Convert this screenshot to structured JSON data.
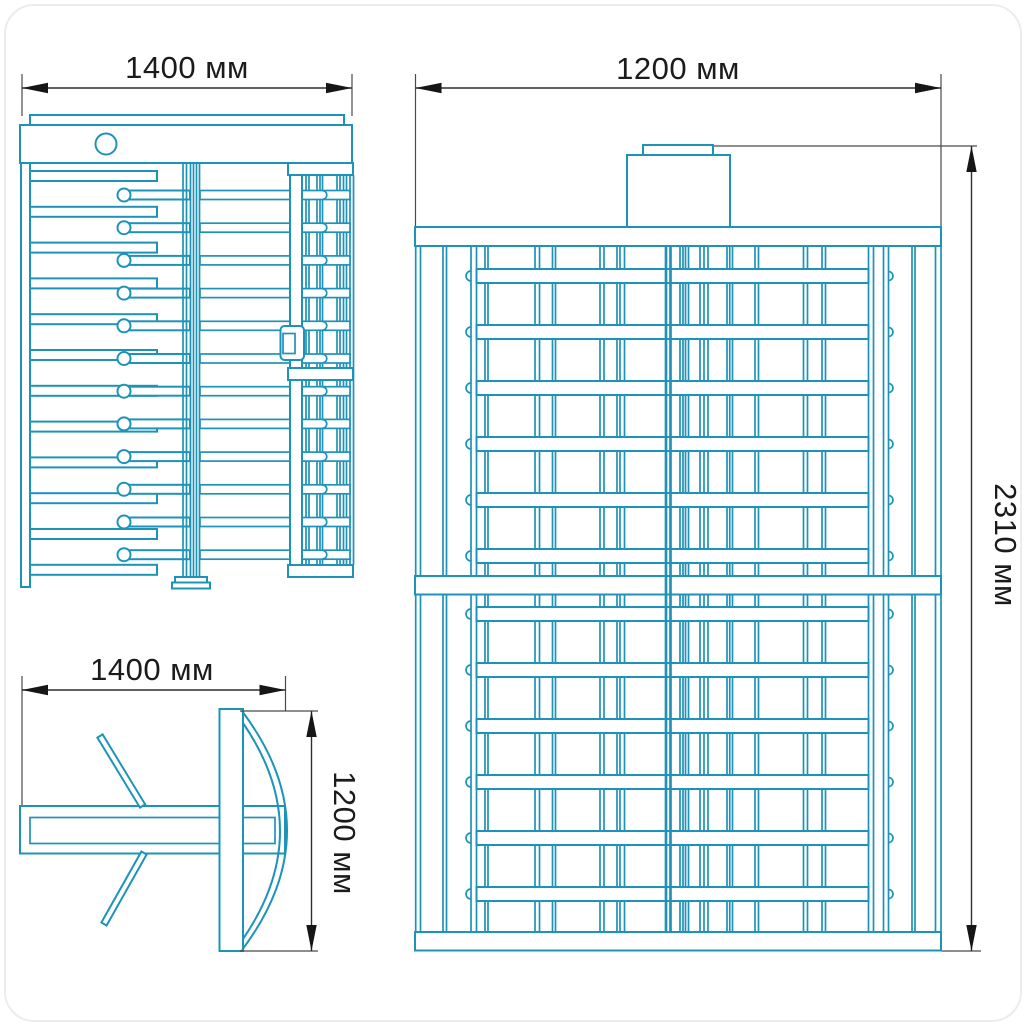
{
  "drawing": {
    "title": "full-height-turnstile-dimension-drawing",
    "line_color": "#1e93b8",
    "dim_text_color": "#1b1b1b",
    "arrow_color": "#161616",
    "views": {
      "side": {
        "width_label": "1400 мм"
      },
      "front": {
        "width_label": "1200 мм",
        "height_label": "2310 мм"
      },
      "plan": {
        "width_label": "1400 мм",
        "depth_label": "1200 мм"
      }
    }
  }
}
